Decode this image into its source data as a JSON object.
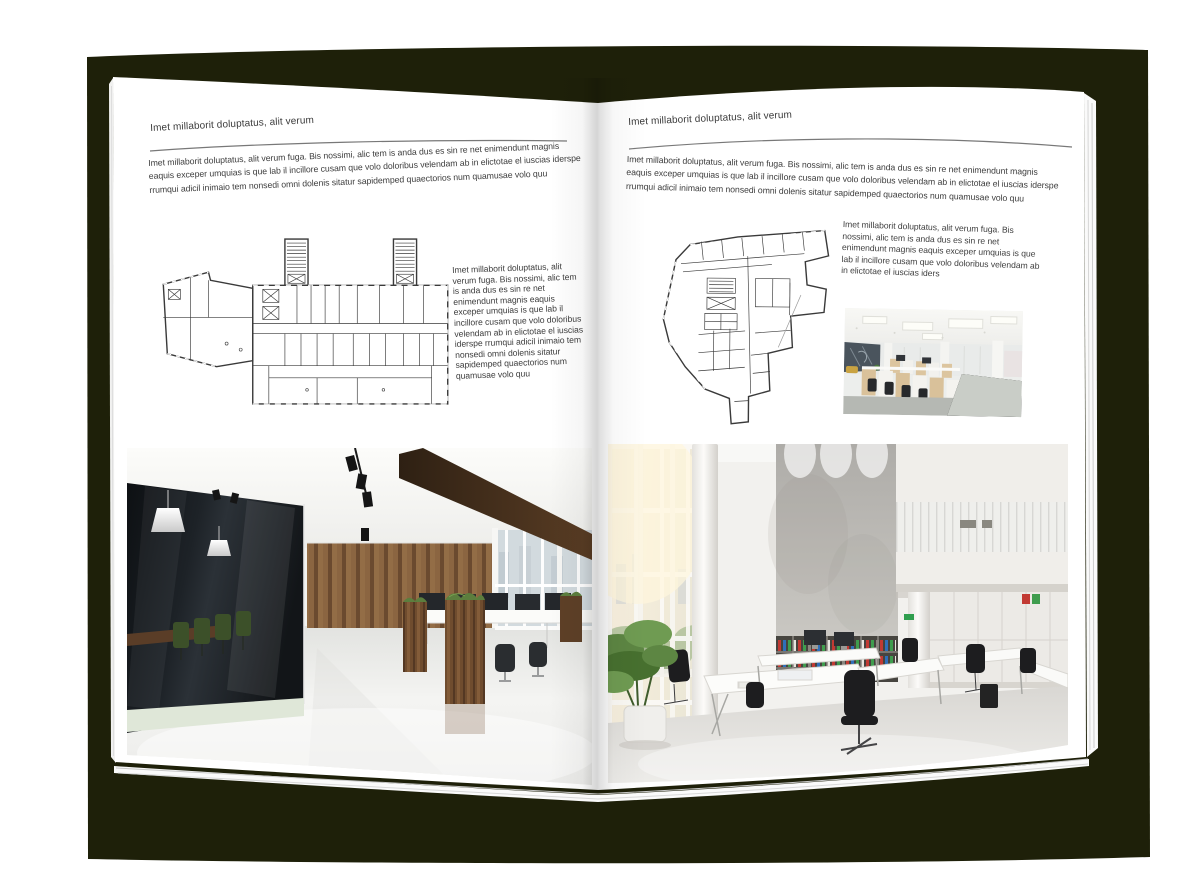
{
  "meta": {
    "description": "Open interior-design brochure spread mockup on dark cover"
  },
  "colors": {
    "cover": "#1e2009",
    "page": "#ffffff",
    "body_text": "#3d3d3d",
    "rule": "#787878",
    "plan_ink": "#3a3a3a"
  },
  "left_page": {
    "header": "Imet millaborit doluptatus, alit verum",
    "intro": "Imet millaborit doluptatus, alit verum fuga. Bis nossimi, alic tem is anda dus es sin re net enimendunt magnis eaquis exceper umquias is que lab il incillore cusam que volo doloribus velendam ab in elictotae el iuscias iderspe rrumqui adicil inimaio tem nonsedi omni dolenis sitatur sapidemped quaectorios num quamusae volo quu",
    "caption": "Imet millaborit doluptatus, alit verum fuga. Bis nossimi, alic tem is anda dus es sin re net enimendunt magnis eaquis exceper umquias is que lab il incillore cusam que volo doloribus velendam ab in elictotae el iuscias iderspe rrumqui adicil inimaio tem nonsedi omni dolenis sitatur sapidemped quaectorios num quamusae volo quu",
    "floor_plan_label": "wide rectangular office wing floor plan with two stair towers and angled annex",
    "photo_label": "office interior photo: dark glass meeting room with green chairs, wood plank wall, white floor and workstations"
  },
  "right_page": {
    "header": "Imet millaborit doluptatus, alit verum",
    "intro": "Imet millaborit doluptatus, alit verum fuga. Bis nossimi, alic tem is anda dus es sin re net enimendunt magnis eaquis exceper umquias is que lab il incillore cusam que volo doloribus velendam ab in elictotae el iuscias iderspe rrumqui adicil inimaio tem nonsedi omni dolenis sitatur sapidemped quaectorios num quamusae volo quu",
    "caption": "Imet millaborit doluptatus, alit verum fuga. Bis nossimi, alic tem is anda dus es sin re net enimendunt magnis eaquis exceper umquias is que lab il incillore cusam que volo doloribus velendam ab in elictotae el iuscias iders",
    "floor_plan_label": "irregular fan-shaped office block floor plan with bottom stem",
    "photo_small_label": "open-plan office photo: rows of cubicle workstations, light wood cabinets, panel lighting",
    "photo_large_label": "bright double-height office photo: glass facade, concrete wall, binder bookshelf, white desks and black chairs"
  }
}
